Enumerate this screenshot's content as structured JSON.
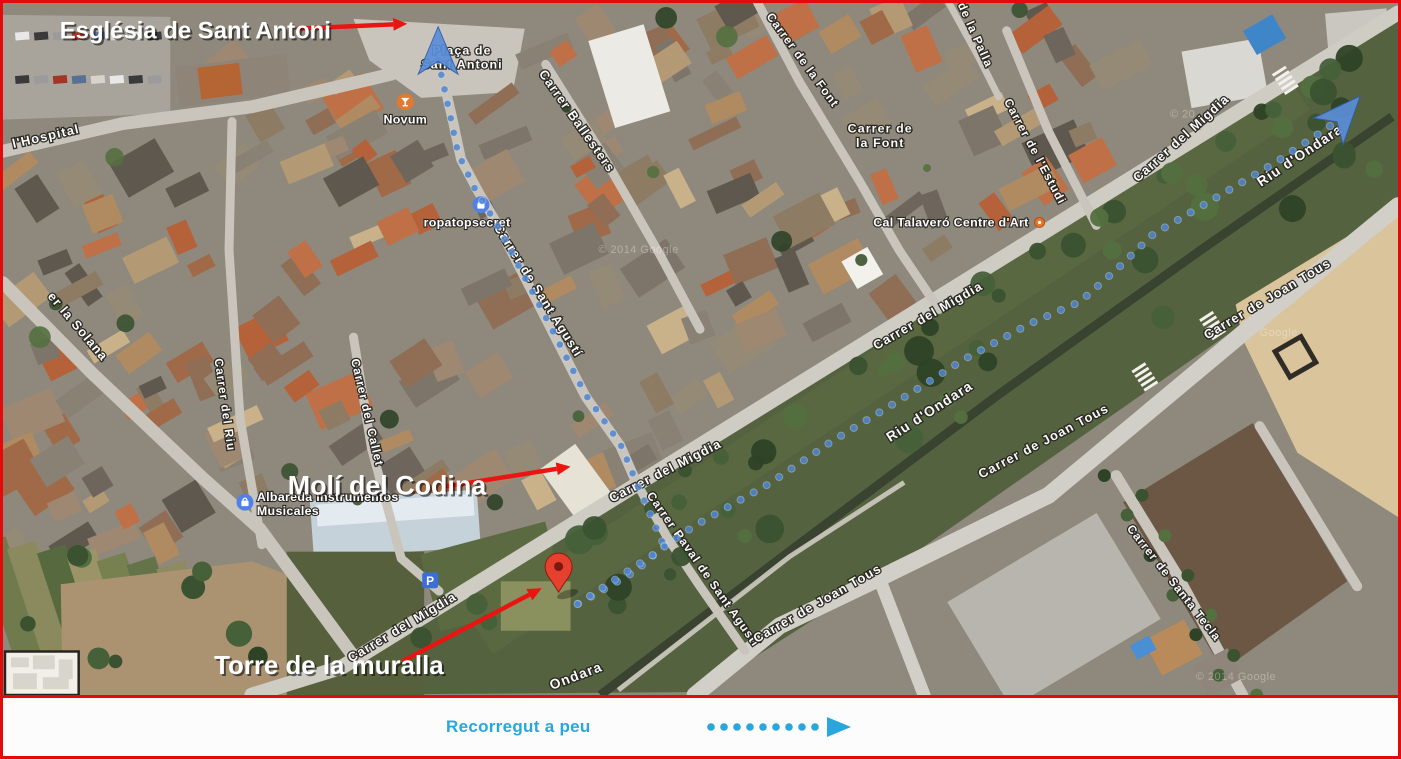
{
  "frame": {
    "border_color": "#e20a0a"
  },
  "legend": {
    "walk_label": "Recorregut a peu",
    "accent_color": "#2ba6dc",
    "dot_count": 9
  },
  "annotations": {
    "arrow_color": "#ea1410",
    "labels": [
      {
        "id": "esglesia",
        "text": "Església de Sant Antoni",
        "x": 57,
        "y": 36,
        "size": 24
      },
      {
        "id": "moli",
        "text": "Molí del Codina",
        "x": 286,
        "y": 497,
        "size": 27
      },
      {
        "id": "torre",
        "text": "Torre de la muralla",
        "x": 212,
        "y": 679,
        "size": 26
      }
    ],
    "arrows": [
      {
        "id": "esglesia-arrow",
        "x1": 295,
        "y1": 26,
        "x2": 406,
        "y2": 21
      },
      {
        "id": "moli-arrow",
        "x1": 445,
        "y1": 489,
        "x2": 570,
        "y2": 469
      },
      {
        "id": "torre-arrow",
        "x1": 401,
        "y1": 666,
        "x2": 541,
        "y2": 592
      }
    ]
  },
  "map": {
    "street_labels": [
      {
        "text": "l'Hospital",
        "x": 44,
        "y": 139,
        "rot": -13,
        "size": 13
      },
      {
        "text": "er la Solana",
        "x": 72,
        "y": 330,
        "rot": 50,
        "size": 13
      },
      {
        "text": "Carrer del Riu",
        "x": 219,
        "y": 407,
        "rot": 82,
        "size": 12
      },
      {
        "text": "Carrer del Callet",
        "x": 362,
        "y": 415,
        "rot": 77,
        "size": 12
      },
      {
        "text": "Carrer de Sant Agustí",
        "x": 534,
        "y": 293,
        "rot": 58,
        "size": 13
      },
      {
        "text": "Carrer Ballesters",
        "x": 573,
        "y": 122,
        "rot": 55,
        "size": 13
      },
      {
        "text": "Carrer de la Font",
        "x": 800,
        "y": 60,
        "rot": 54,
        "size": 12
      },
      {
        "text": "de la Palla",
        "x": 973,
        "y": 34,
        "rot": 66,
        "size": 12
      },
      {
        "text": "Carrer de l'Estudi",
        "x": 1033,
        "y": 152,
        "rot": 62,
        "size": 12
      },
      {
        "text": "Carrer del Migdia",
        "x": 1186,
        "y": 140,
        "rot": -42,
        "size": 13
      },
      {
        "text": "Carrer del Migdia",
        "x": 931,
        "y": 320,
        "rot": -30,
        "size": 13
      },
      {
        "text": "Carrer del Migdia",
        "x": 667,
        "y": 477,
        "rot": -27,
        "size": 13
      },
      {
        "text": "Carrer del Migdia",
        "x": 403,
        "y": 635,
        "rot": -31,
        "size": 13
      },
      {
        "text": "Riu d'Ondara",
        "x": 1305,
        "y": 158,
        "rot": -34,
        "size": 14
      },
      {
        "text": "Riu d'Ondara",
        "x": 933,
        "y": 417,
        "rot": -33,
        "size": 14
      },
      {
        "text": "Ondara",
        "x": 577,
        "y": 685,
        "rot": -21,
        "size": 14
      },
      {
        "text": "Carrer Raval de Sant Agustí",
        "x": 700,
        "y": 575,
        "rot": 55,
        "size": 12
      },
      {
        "text": "Carrer de Joan Tous",
        "x": 820,
        "y": 611,
        "rot": -30,
        "size": 13
      },
      {
        "text": "Carrer de Joan Tous",
        "x": 1047,
        "y": 447,
        "rot": -28,
        "size": 13
      },
      {
        "text": "Carrer de Joan Tous",
        "x": 1272,
        "y": 303,
        "rot": -31,
        "size": 13
      },
      {
        "text": "Carrer de Santa Tecla",
        "x": 1173,
        "y": 589,
        "rot": 52,
        "size": 12
      }
    ],
    "place_labels": [
      {
        "lines": [
          "Plaça de",
          "Sant Antoni"
        ],
        "x": 461,
        "y": 52,
        "size": 12.5
      },
      {
        "lines": [
          "Carrer de",
          "la Font"
        ],
        "x": 881,
        "y": 131,
        "size": 12.5
      }
    ],
    "pois": [
      {
        "name": "Novum",
        "icon": "drink-icon",
        "x": 404,
        "y": 100,
        "label_lines": [
          "Novum"
        ],
        "label_pos": "below"
      },
      {
        "name": "ropatopsecret",
        "icon": "shopping-bag-icon",
        "x": 480,
        "y": 204,
        "label_lines": [
          "ropatopsecret"
        ],
        "label_pos": "below-left"
      },
      {
        "name": "Albareda Instrumentos Musicales",
        "icon": "shopping-bag-icon",
        "x": 243,
        "y": 505,
        "label_lines": [
          "Albareda Instrumentos",
          "Musicales"
        ],
        "label_pos": "right"
      },
      {
        "name": "Cal Talaveró Centre d'Art",
        "icon": "gallery-dot-icon",
        "x": 1041,
        "y": 222,
        "label_lines": [
          "Cal Talaveró Centre d'Art"
        ],
        "label_pos": "left"
      }
    ],
    "parking": {
      "glyph": "P",
      "x": 429,
      "y": 584
    },
    "pin": {
      "x": 558,
      "y": 596
    },
    "route": {
      "color": "#4f86d2",
      "dot_radius": 3.6,
      "dot_spacing": 15,
      "segments": [
        [
          [
            437,
            58
          ],
          [
            450,
            118
          ],
          [
            457,
            152
          ],
          [
            474,
            188
          ],
          [
            497,
            226
          ],
          [
            540,
            308
          ],
          [
            585,
            396
          ],
          [
            620,
            446
          ],
          [
            637,
            487
          ],
          [
            664,
            549
          ]
        ],
        [
          [
            664,
            549
          ],
          [
            636,
            574
          ],
          [
            597,
            597
          ],
          [
            566,
            614
          ]
        ],
        [
          [
            577,
            608
          ],
          [
            650,
            560
          ],
          [
            694,
            529
          ],
          [
            770,
            486
          ],
          [
            833,
            443
          ],
          [
            900,
            402
          ],
          [
            966,
            360
          ],
          [
            1030,
            325
          ],
          [
            1082,
            302
          ],
          [
            1120,
            268
          ],
          [
            1155,
            234
          ],
          [
            1220,
            196
          ],
          [
            1280,
            160
          ],
          [
            1344,
            117
          ]
        ]
      ],
      "start_arrow": {
        "x": 437,
        "y": 48,
        "rot": 0
      },
      "end_arrow": {
        "x": 1347,
        "y": 112,
        "rot": 42
      }
    },
    "watermarks": [
      {
        "text": "© 2014 Google",
        "x": 598,
        "y": 253
      },
      {
        "text": "© 20",
        "x": 1172,
        "y": 116
      },
      {
        "text": "Google",
        "x": 1262,
        "y": 337
      },
      {
        "text": "© 2014 Google",
        "x": 1198,
        "y": 685
      }
    ]
  }
}
